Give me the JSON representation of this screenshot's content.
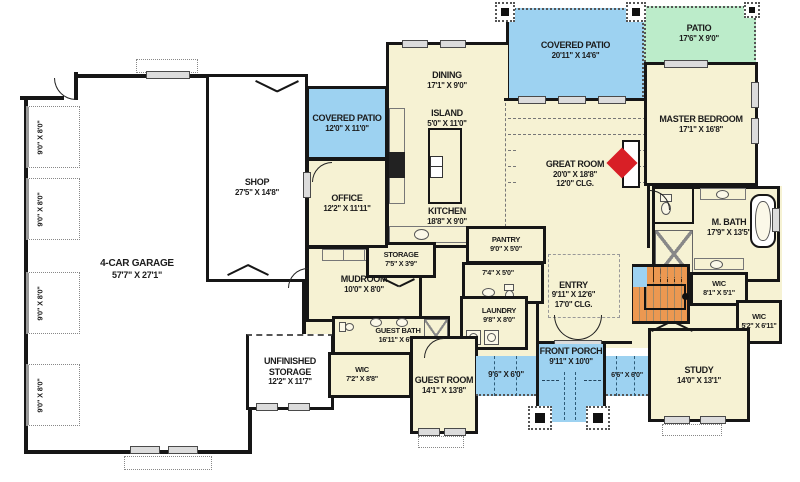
{
  "colors": {
    "wall": "#161616",
    "floor": "#f6f2d3",
    "patio_blue": "#9dd2f1",
    "patio_green": "#bcecca",
    "stairs_orange": "#ec9851",
    "fireplace_red": "#d81f26"
  },
  "rooms": {
    "garage": {
      "name": "4-CAR GARAGE",
      "dims": "57'7\" X 27'1\""
    },
    "shop": {
      "name": "SHOP",
      "dims": "27'5\" X 14'8\""
    },
    "covered_patio_small": {
      "name": "COVERED PATIO",
      "dims": "12'0\" X 11'0\""
    },
    "office": {
      "name": "OFFICE",
      "dims": "12'2\" X 11'11\""
    },
    "dining": {
      "name": "DINING",
      "dims": "17'1\" X 9'0\""
    },
    "island": {
      "name": "ISLAND",
      "dims": "5'0\" X 11'0\""
    },
    "kitchen": {
      "name": "KITCHEN",
      "dims": "18'8\" X 9'0\""
    },
    "covered_patio_large": {
      "name": "COVERED PATIO",
      "dims": "20'11\" X 14'6\""
    },
    "patio": {
      "name": "PATIO",
      "dims": "17'6\" X 9'0\""
    },
    "great_room": {
      "name": "GREAT ROOM",
      "dims": "20'0\" X 18'8\"",
      "note": "12'0\" CLG."
    },
    "master_bedroom": {
      "name": "MASTER BEDROOM",
      "dims": "17'1\" X 16'8\""
    },
    "m_bath": {
      "name": "M. BATH",
      "dims": "17'9\" X 13'5\""
    },
    "mudroom": {
      "name": "MUDROOM",
      "dims": "10'0\" X 8'0\""
    },
    "storage": {
      "name": "STORAGE",
      "dims": "7'5\" X 3'9\""
    },
    "pantry": {
      "name": "PANTRY",
      "dims": "9'0\" X 5'0\""
    },
    "powder_hall": {
      "dims": "7'4\" X 5'0\""
    },
    "entry": {
      "name": "ENTRY",
      "dims": "9'11\" X 12'6\"",
      "note": "17'0\" CLG."
    },
    "laundry": {
      "name": "LAUNDRY",
      "dims": "9'8\" X 8'0\""
    },
    "guest_bath": {
      "name": "GUEST BATH",
      "dims": "16'11\" X 6'0\""
    },
    "wic_guest": {
      "name": "WIC",
      "dims": "7'2\" X 8'8\""
    },
    "guest_room": {
      "name": "GUEST ROOM",
      "dims": "14'1\" X 13'8\""
    },
    "unfinished_storage": {
      "name": "UNFINISHED STORAGE",
      "dims": "12'2\" X 11'7\""
    },
    "wic_master": {
      "name": "WIC",
      "dims": "8'1\" X 5'1\""
    },
    "wic_study": {
      "name": "WIC",
      "dims": "5'2\" X 6'11\""
    },
    "study": {
      "name": "STUDY",
      "dims": "14'0\" X 13'1\""
    },
    "front_porch": {
      "name": "FRONT PORCH",
      "dims": "9'11\" X 10'0\""
    },
    "porch_left": {
      "dims": "9'6\" X 6'0\""
    },
    "porch_right": {
      "dims": "6'6\" X 6'0\""
    },
    "garage_door": {
      "dims": "9'0\" X 8'0\""
    },
    "stairs": {
      "label": "DN"
    }
  }
}
